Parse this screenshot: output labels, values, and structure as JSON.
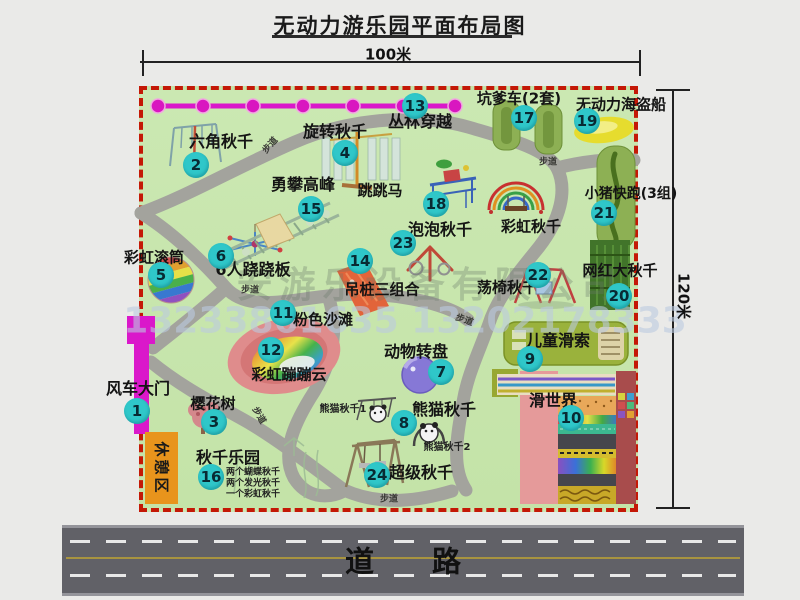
{
  "title": "无动力游乐园平面布局图",
  "dimensions": {
    "width_label": "100米",
    "height_label": "120米"
  },
  "road": {
    "label": "道路"
  },
  "rest_area": {
    "label": "休憩区"
  },
  "watermark": {
    "company": "安游乐设备有限公司",
    "phone": "13233861635 13202178333"
  },
  "colors": {
    "park_green": "#c8e6ae",
    "border_red": "#c41806",
    "badge_cyan": "#2fc7c9",
    "magenta": "#da18ca",
    "road_gray": "#616167",
    "rest_orange": "#e8941c"
  },
  "attractions": [
    {
      "num": "1",
      "name": "风车大门",
      "badge": {
        "x": 137,
        "y": 411
      },
      "label": {
        "x": 138,
        "y": 389,
        "size": 16
      }
    },
    {
      "num": "2",
      "name": "六角秋千",
      "badge": {
        "x": 196,
        "y": 165
      },
      "label": {
        "x": 221,
        "y": 142,
        "size": 16
      }
    },
    {
      "num": "3",
      "name": "樱花树",
      "badge": {
        "x": 214,
        "y": 422
      },
      "label": {
        "x": 213,
        "y": 404,
        "size": 15
      }
    },
    {
      "num": "4",
      "name": "旋转秋千",
      "badge": {
        "x": 345,
        "y": 153
      },
      "label": {
        "x": 335,
        "y": 132,
        "size": 16
      }
    },
    {
      "num": "5",
      "name": "彩虹滚筒",
      "badge": {
        "x": 161,
        "y": 275
      },
      "label": {
        "x": 154,
        "y": 258,
        "size": 15
      }
    },
    {
      "num": "6",
      "name": "6人跷跷板",
      "badge": {
        "x": 221,
        "y": 256
      },
      "label": {
        "x": 253,
        "y": 270,
        "size": 16
      }
    },
    {
      "num": "7",
      "name": "动物转盘",
      "badge": {
        "x": 441,
        "y": 372
      },
      "label": {
        "x": 416,
        "y": 352,
        "size": 16
      }
    },
    {
      "num": "8",
      "name": "熊猫秋千",
      "badge": {
        "x": 404,
        "y": 423
      },
      "label": {
        "x": 444,
        "y": 410,
        "size": 16
      }
    },
    {
      "num": "9",
      "name": "儿童滑索",
      "badge": {
        "x": 530,
        "y": 359
      },
      "label": {
        "x": 558,
        "y": 341,
        "size": 16
      }
    },
    {
      "num": "10",
      "name": "滑世界",
      "badge": {
        "x": 571,
        "y": 418
      },
      "label": {
        "x": 553,
        "y": 401,
        "size": 16
      }
    },
    {
      "num": "11",
      "name": "粉色沙滩",
      "badge": {
        "x": 283,
        "y": 313
      },
      "label": {
        "x": 323,
        "y": 320,
        "size": 15
      }
    },
    {
      "num": "12",
      "name": "彩虹蹦蹦云",
      "badge": {
        "x": 271,
        "y": 350
      },
      "label": {
        "x": 289,
        "y": 375,
        "size": 15
      }
    },
    {
      "num": "13",
      "name": "丛林穿越",
      "badge": {
        "x": 415,
        "y": 106
      },
      "label": {
        "x": 420,
        "y": 122,
        "size": 16
      }
    },
    {
      "num": "14",
      "name": "吊桩三组合",
      "badge": {
        "x": 360,
        "y": 261
      },
      "label": {
        "x": 382,
        "y": 290,
        "size": 15
      }
    },
    {
      "num": "15",
      "name": "勇攀高峰",
      "badge": {
        "x": 311,
        "y": 209
      },
      "label": {
        "x": 303,
        "y": 185,
        "size": 16
      }
    },
    {
      "num": "16",
      "name": "秋千乐园",
      "badge": {
        "x": 211,
        "y": 477
      },
      "label": {
        "x": 228,
        "y": 458,
        "size": 16
      }
    },
    {
      "num": "17",
      "name": "坑爹车(2套)",
      "badge": {
        "x": 524,
        "y": 118
      },
      "label": {
        "x": 519,
        "y": 99,
        "size": 15
      }
    },
    {
      "num": "18",
      "name": "跳跳马",
      "badge": {
        "x": 436,
        "y": 204
      },
      "label": {
        "x": 380,
        "y": 191,
        "size": 15
      }
    },
    {
      "num": "19",
      "name": "无动力海盗船",
      "badge": {
        "x": 587,
        "y": 121
      },
      "label": {
        "x": 621,
        "y": 105,
        "size": 15
      }
    },
    {
      "num": "20",
      "name": "网红大秋千",
      "badge": {
        "x": 619,
        "y": 296
      },
      "label": {
        "x": 620,
        "y": 271,
        "size": 15
      }
    },
    {
      "num": "21",
      "name": "小猪快跑(3组)",
      "badge": {
        "x": 604,
        "y": 213
      },
      "label": {
        "x": 631,
        "y": 194,
        "size": 14
      }
    },
    {
      "num": "22",
      "name": "荡椅秋千",
      "badge": {
        "x": 538,
        "y": 275
      },
      "label": {
        "x": 507,
        "y": 288,
        "size": 15
      }
    },
    {
      "num": "23",
      "name": "泡泡秋千",
      "badge": {
        "x": 403,
        "y": 243
      },
      "label": {
        "x": 440,
        "y": 230,
        "size": 16
      }
    },
    {
      "num": "24",
      "name": "超级秋千",
      "badge": {
        "x": 377,
        "y": 475
      },
      "label": {
        "x": 421,
        "y": 473,
        "size": 16
      }
    },
    {
      "num": null,
      "name": "彩虹秋千",
      "badge": null,
      "label": {
        "x": 531,
        "y": 227,
        "size": 15
      }
    }
  ],
  "sub_labels": [
    {
      "text": "两个蝴蝶秋千",
      "x": 253,
      "y": 473,
      "size": 9
    },
    {
      "text": "两个发光秋千",
      "x": 253,
      "y": 484,
      "size": 9
    },
    {
      "text": "一个彩虹秋千",
      "x": 253,
      "y": 495,
      "size": 9
    },
    {
      "text": "熊猫秋千1",
      "x": 343,
      "y": 410,
      "size": 10
    },
    {
      "text": "熊猫秋千2",
      "x": 447,
      "y": 448,
      "size": 10
    }
  ],
  "path_labels": [
    {
      "text": "步道",
      "x": 271,
      "y": 146,
      "rotate": -48
    },
    {
      "text": "步道",
      "x": 548,
      "y": 163,
      "rotate": 0
    },
    {
      "text": "步道",
      "x": 250,
      "y": 291,
      "rotate": 0
    },
    {
      "text": "步道",
      "x": 464,
      "y": 321,
      "rotate": 20
    },
    {
      "text": "步道",
      "x": 258,
      "y": 416,
      "rotate": 60
    },
    {
      "text": "步道",
      "x": 389,
      "y": 500,
      "rotate": 0
    }
  ]
}
